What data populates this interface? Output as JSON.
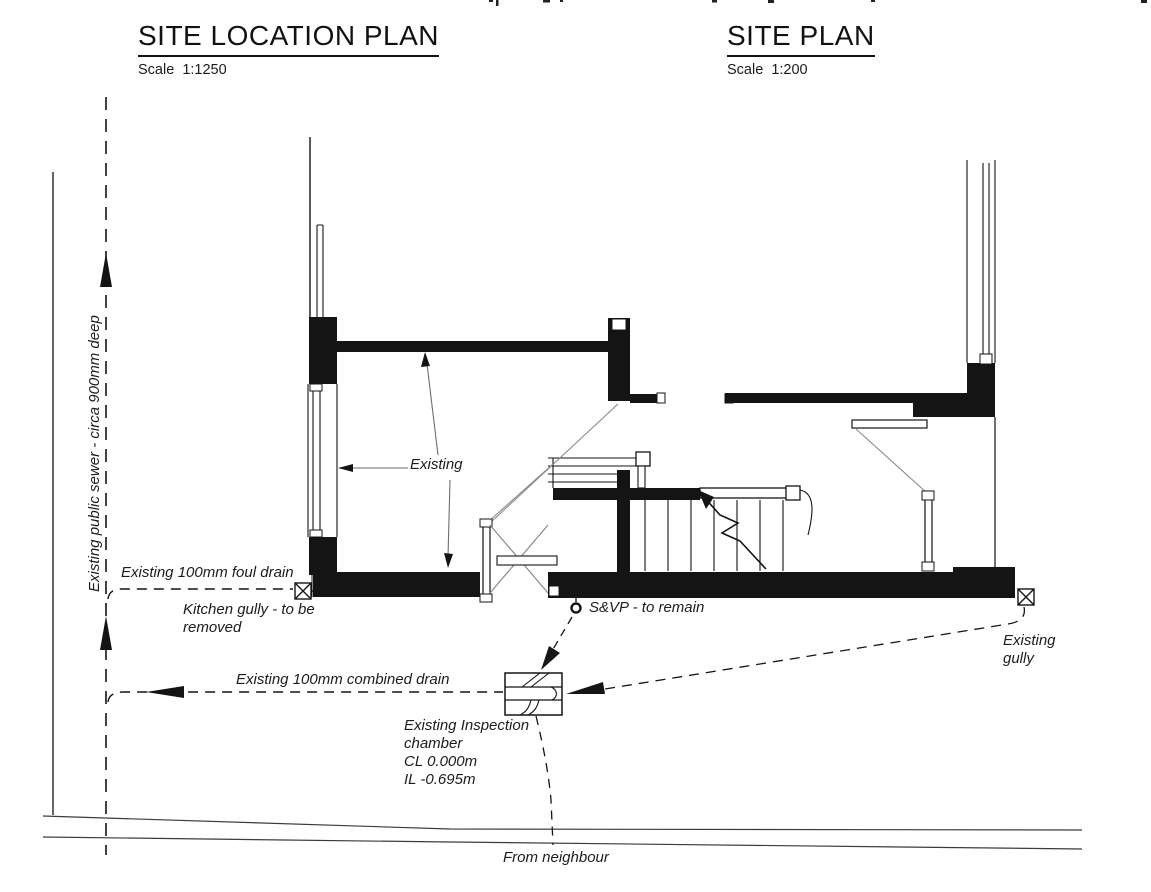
{
  "page": {
    "background": "#ffffff",
    "line_color": "#141414",
    "leader_color": "#6e6e6e",
    "road_color": "#3c3c3c"
  },
  "site_location_plan": {
    "title": "SITE LOCATION PLAN",
    "scale": "Scale  1:1250"
  },
  "site_plan": {
    "title": "SITE PLAN",
    "scale": "Scale  1:200"
  },
  "annotations": {
    "public_sewer": "Existing public sewer - circa 900mm deep",
    "foul_drain": "Existing 100mm foul drain",
    "kitchen_gully_line1": "Kitchen gully - to be",
    "kitchen_gully_line2": "removed",
    "existing_pointer": "Existing",
    "svp": "S&VP - to remain",
    "existing_gully_line1": "Existing",
    "existing_gully_line2": "gully",
    "combined_drain": "Existing 100mm combined drain",
    "inspection_chamber_line1": "Existing Inspection",
    "inspection_chamber_line2": "chamber",
    "inspection_chamber_cover_level": "CL 0.000m",
    "inspection_chamber_invert_level": "IL -0.695m",
    "from_neighbour": "From neighbour"
  }
}
